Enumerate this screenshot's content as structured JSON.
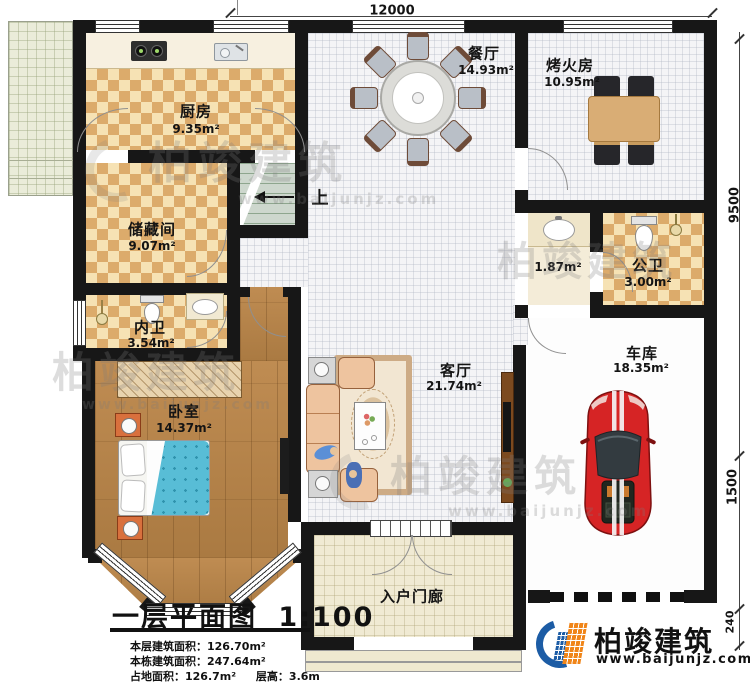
{
  "plan": {
    "dims": {
      "top": "12000",
      "right_upper": "9500",
      "right_mid": "1500",
      "right_lower": "240"
    },
    "rooms": {
      "kitchen": {
        "name": "厨房",
        "area": "9.35m²"
      },
      "dining": {
        "name": "餐厅",
        "area": "14.93m²"
      },
      "fire_room": {
        "name": "烤火房",
        "area": "10.95m²"
      },
      "storage": {
        "name": "储藏间",
        "area": "9.07m²"
      },
      "wash_area": {
        "area": "1.87m²"
      },
      "public_bath": {
        "name": "公卫",
        "area": "3.00m²"
      },
      "private_bath": {
        "name": "内卫",
        "area": "3.54m²"
      },
      "bedroom": {
        "name": "卧室",
        "area": "14.37m²"
      },
      "living": {
        "name": "客厅",
        "area": "21.74m²"
      },
      "garage": {
        "name": "车库",
        "area": "18.35m²"
      },
      "porch": {
        "name": "入户门廊"
      }
    },
    "stairs_up_label": "上"
  },
  "title_block": {
    "title": "一层平面图",
    "scale": "1:100",
    "info_line1": "本层建筑面积：126.70m²",
    "info_line2": "本栋建筑面积：247.64m²",
    "info_line3a": "占地面积：126.7m²",
    "info_line3b": "层高：3.6m"
  },
  "branding": {
    "company": "柏竣建筑",
    "website": "www.baijunjz.com"
  },
  "watermark": {
    "text": "柏竣建筑",
    "subtext": "www.baijunjz.com"
  },
  "colors": {
    "wall": "#171717",
    "accent_blue": "#1c5ca5",
    "accent_orange": "#f08519",
    "car_red": "#d62425",
    "bed_blue": "#58bdd6"
  }
}
